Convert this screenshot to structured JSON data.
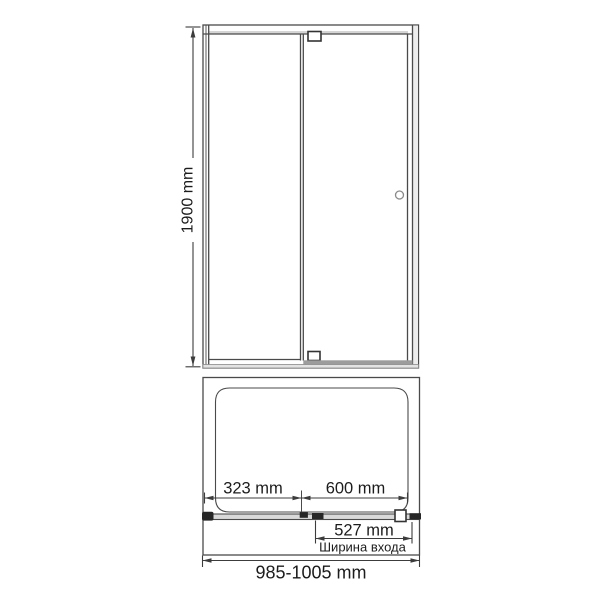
{
  "front_view": {
    "height_dimension": "1900 mm"
  },
  "plan_view": {
    "fixed_panel_dimension": "323 mm",
    "door_dimension": "600 mm",
    "entrance_dimension": "527 mm",
    "entrance_caption": "Ширина входа",
    "overall_width_dimension": "985-1005 mm"
  },
  "colors": {
    "line": "#4a4a4a",
    "text": "#1c1c1c",
    "dark_fill": "#262626",
    "light_fill": "#d9d9d9",
    "mid_fill": "#9c9c9c"
  }
}
